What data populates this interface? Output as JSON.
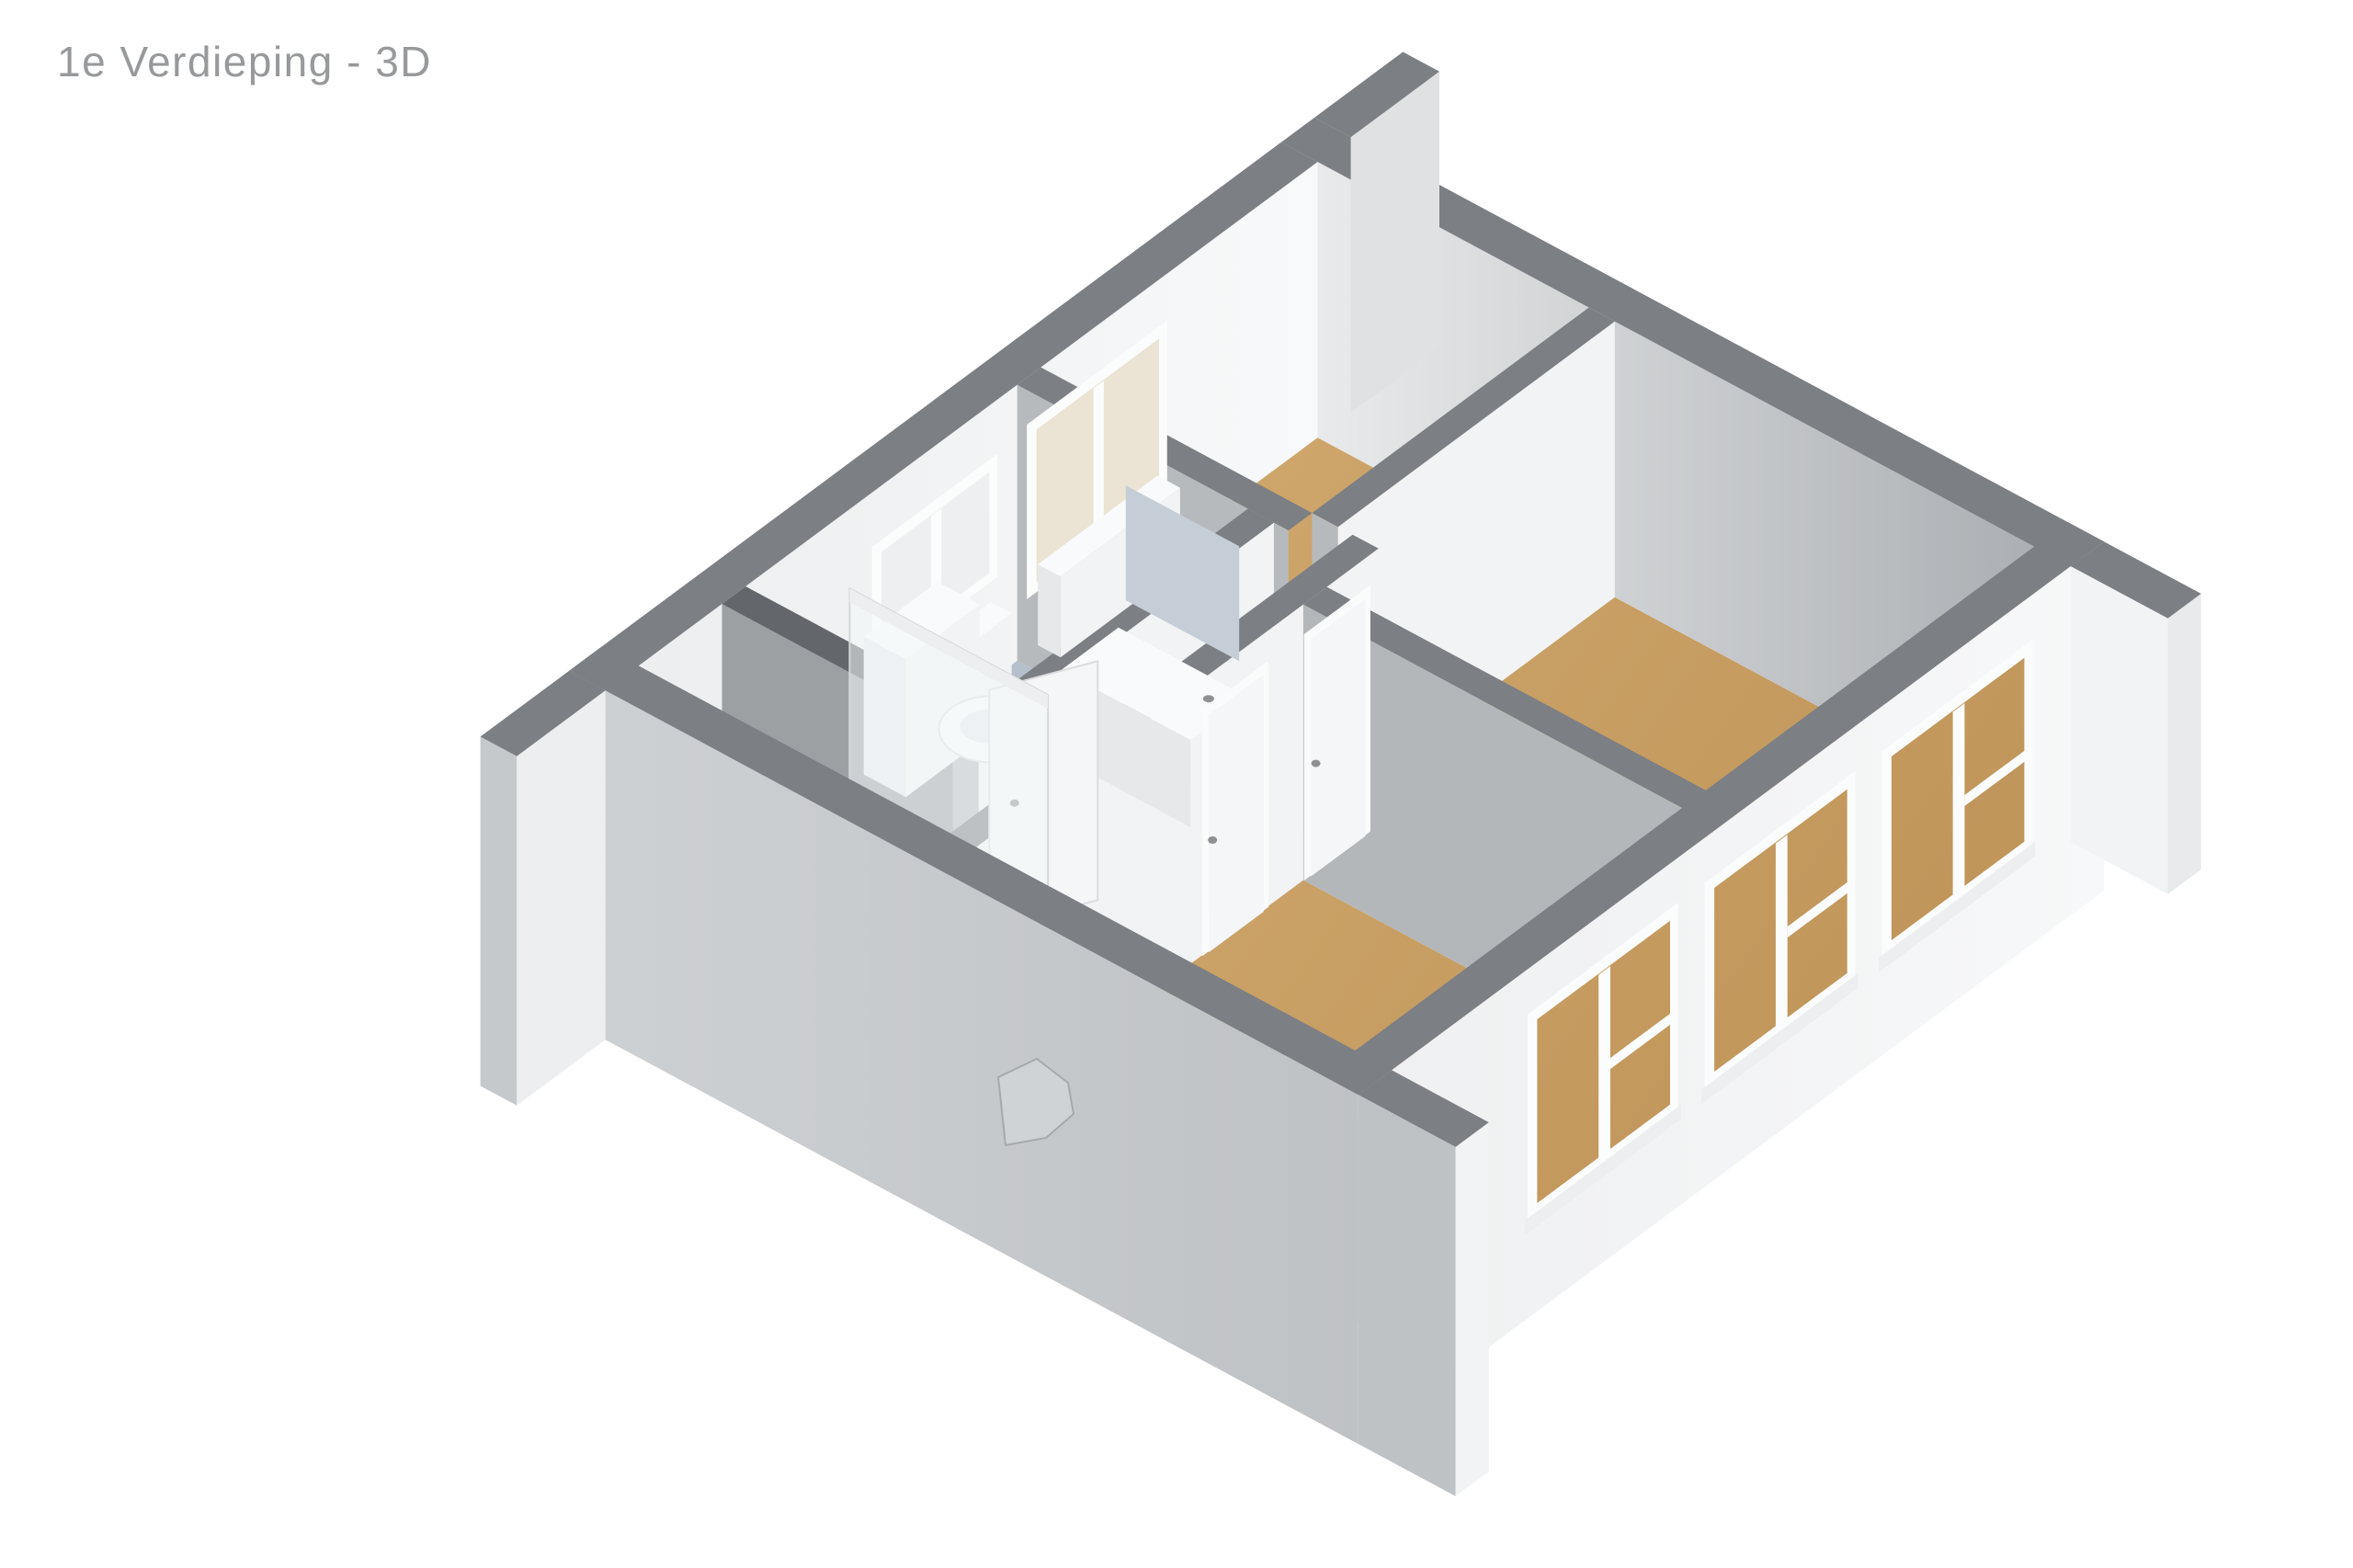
{
  "page": {
    "title": "1e Verdieping - 3D"
  },
  "render": {
    "type": "3d-floorplan-isometric",
    "colors": {
      "background": "#ffffff",
      "title_text": "#97999b",
      "wall_top": "#7c7f83",
      "wall_top_dark": "#63666a",
      "wall_face_light": "#f2f3f4",
      "wall_face_shadow": "#b7babc",
      "interior_ne_light": "#e8eaeb",
      "interior_ne_dark": "#a9acb0",
      "interior_nw_light": "#f8f9fa",
      "interior_nw_dim": "#eceeef",
      "exterior_sw_light": "#ced1d3",
      "exterior_sw_dark": "#bfc2c5",
      "exterior_se_light": "#f7f8f9",
      "exterior_se_dim": "#eff0f1",
      "floor_wood_light": "#d2ab70",
      "floor_wood_dark": "#c0955a",
      "floor_bath_light": "#bcc6d1",
      "floor_bath_dark": "#aeb9c6",
      "window_glass_cream": "#ebe3d3",
      "window_glass_white": "#edeff0",
      "window_frame": "#fbfcfc",
      "window_sill": "#eceeef",
      "door_frame": "#fafbfb",
      "door_leaf": "#f4f6f7",
      "door_edge": "#dadcde",
      "handle_gray": "#8e9193",
      "fixture_white": "#f9fafb",
      "fixture_shade": "#e6e8ea",
      "shaft_dark": "#5e6164",
      "glass_stroke": "#d5d8da",
      "stair_gray": "#d0d3d5",
      "stair_edge": "#a6a9ab",
      "wing_ne_face": "#dfe1e3",
      "wing_cap": "#e8eaeb",
      "wing_s_face": "#bfc2c4",
      "wing_w_cap": "#c6c9cb"
    }
  }
}
